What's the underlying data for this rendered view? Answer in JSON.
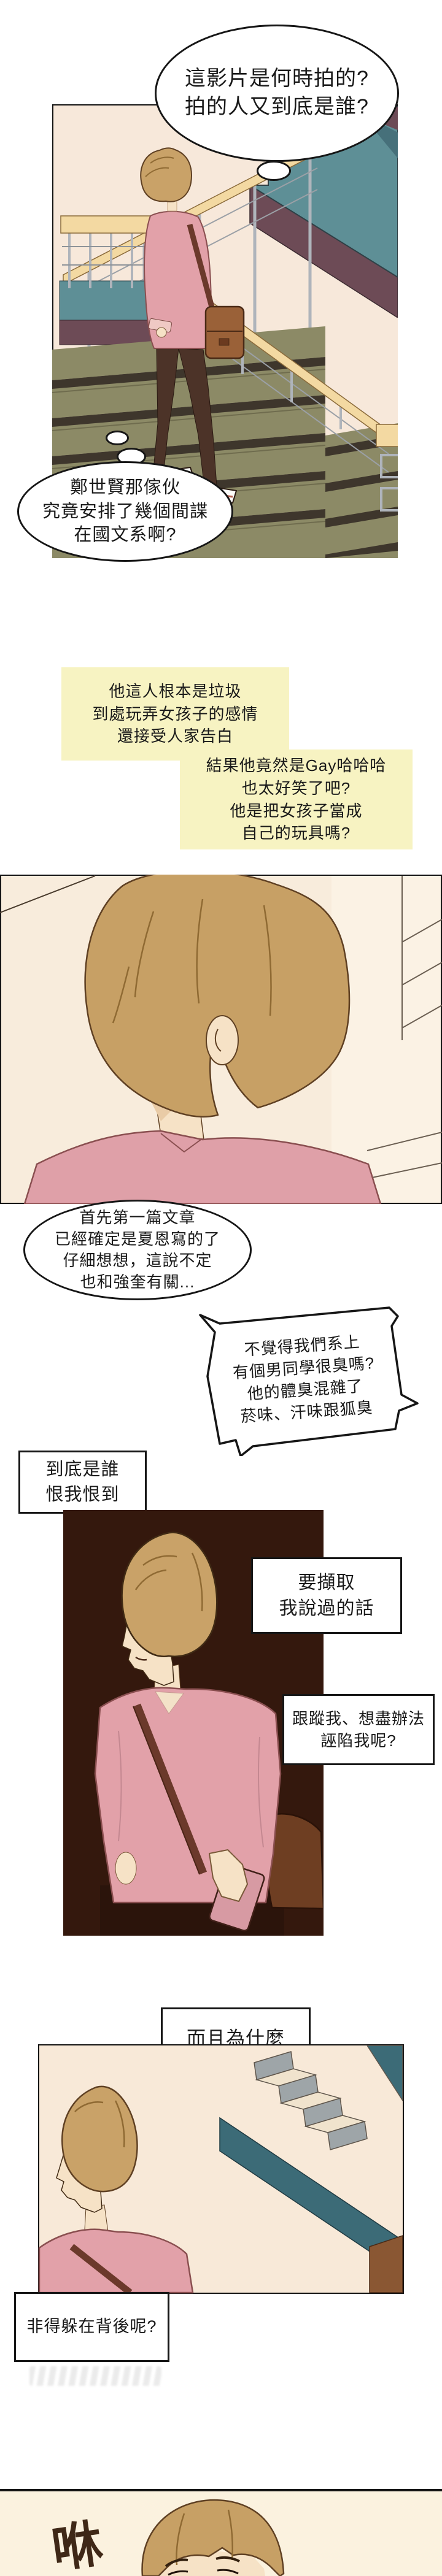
{
  "page_type": "webtoon-comic-page",
  "thought_bubbles": {
    "b1": "這影片是何時拍的?\n拍的人又到底是誰?",
    "b2": "鄭世賢那傢伙\n究竟安排了幾個間諜\n在國文系啊?",
    "b3": "首先第一篇文章\n已經確定是夏恩寫的了\n仔細想想，這說不定\n也和強奎有關...",
    "spiky": "不覺得我們系上\n有個男同學很臭嗎?\n他的體臭混雜了\n菸味、汗味跟狐臭"
  },
  "captions": {
    "yellow1": "他這人根本是垃圾\n到處玩弄女孩子的感情\n還接受人家告白",
    "yellow2": "結果他竟然是Gay哈哈哈\n也太好笑了吧?\n他是把女孩子當成\n自己的玩具嗎?",
    "narr1": "到底是誰\n恨我恨到",
    "narr2": "要擷取\n我說過的話",
    "narr3": "跟蹤我、想盡辦法\n誣陷我呢?",
    "narr4": "而且為什麼",
    "narr5": "非得躲在背後呢?"
  },
  "sfx": {
    "whoosh": "咻"
  },
  "colors": {
    "page_bg": "#FFFFFF",
    "caption_yellow_bg": "#F7F3C2",
    "panel1_wall": "#F7E8DA",
    "panel_dark_bg": "#34180D",
    "panel4_wall": "#F8E9D8",
    "panel5_bg": "#FBF2DF",
    "hair_tan": "#C9A268",
    "skin": "#F6E2C6",
    "shirt_pink": "#E2A1A9",
    "pants_brown": "#4C3328",
    "bag_brown": "#9A6138",
    "strap_brown": "#6B392B",
    "phone_pink": "#D79AA3",
    "stairs_teal": "#5E8F96",
    "stairs_mauve": "#6D4B56",
    "stairs_olive": "#8C8A66",
    "wood_rail": "#F3D9A2",
    "banister_teal": "#3C6B77",
    "sfx_brown": "#3F2817"
  }
}
